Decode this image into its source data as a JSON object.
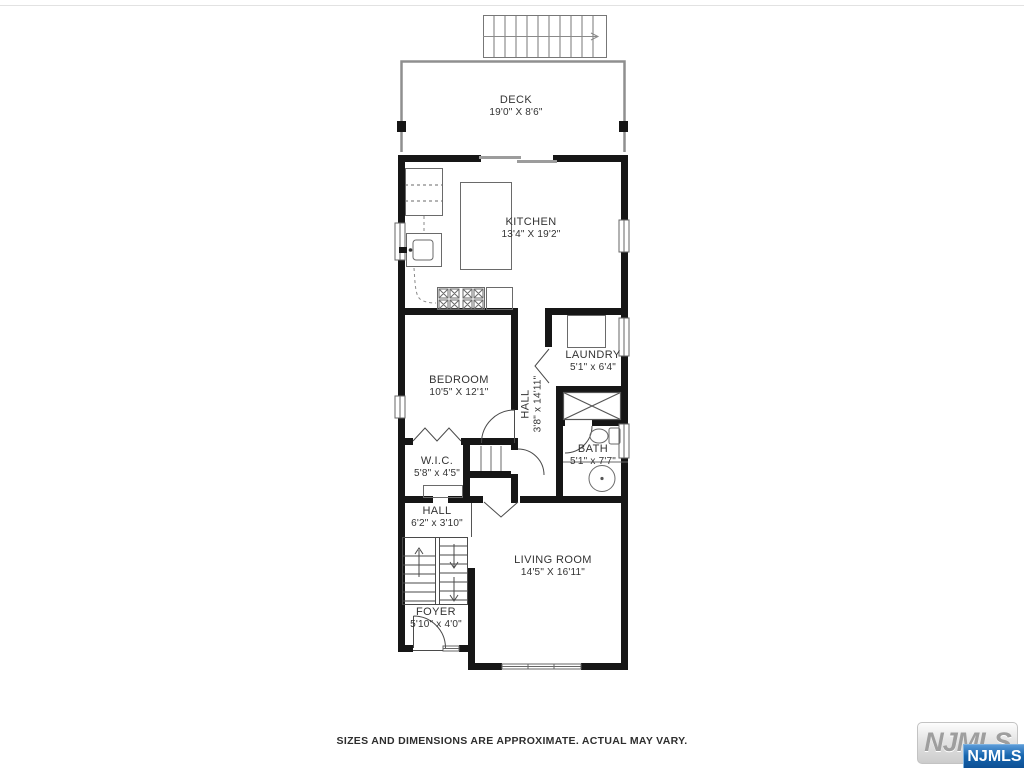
{
  "floorplan": {
    "rooms": {
      "deck": {
        "name": "DECK",
        "dims": "19'0\" X 8'6\""
      },
      "kitchen": {
        "name": "KITCHEN",
        "dims": "13'4\" X 19'2\""
      },
      "bedroom": {
        "name": "BEDROOM",
        "dims": "10'5\" X 12'1\""
      },
      "laundry": {
        "name": "LAUNDRY",
        "dims": "5'1\" x 6'4\""
      },
      "hall_upper": {
        "name": "HALL",
        "dims": "3'8\" x 14'11\""
      },
      "bath": {
        "name": "BATH",
        "dims": "5'1\" x 7'7\""
      },
      "wic": {
        "name": "W.I.C.",
        "dims": "5'8\" x 4'5\""
      },
      "hall_lower": {
        "name": "HALL",
        "dims": "6'2\" x 3'10\""
      },
      "living_room": {
        "name": "LIVING ROOM",
        "dims": "14'5\" X 16'11\""
      },
      "foyer": {
        "name": "FOYER",
        "dims": "5'10\" x 4'0\""
      }
    },
    "disclaimer": "SIZES AND DIMENSIONS ARE APPROXIMATE. ACTUAL MAY VARY.",
    "branding": {
      "watermark": "NJMLS",
      "badge": "NJMLS"
    },
    "colors": {
      "wall": "#161616",
      "fixture_line": "#6a6a6a",
      "badge_blue": "#0c4d92",
      "watermark_gray": "#9e9e9e"
    }
  }
}
